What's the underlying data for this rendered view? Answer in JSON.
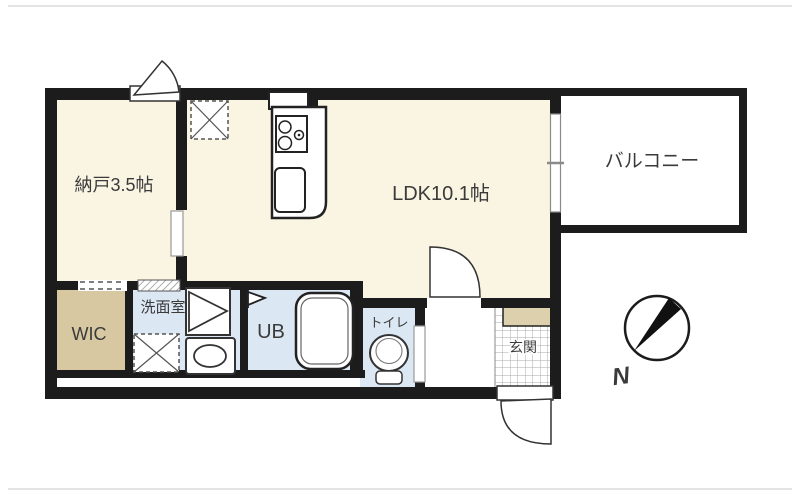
{
  "floorplan": {
    "rooms": {
      "nando": {
        "label": "納戸3.5帖"
      },
      "ldk": {
        "label": "LDK10.1帖"
      },
      "balcony": {
        "label": "バルコニー"
      },
      "wic": {
        "label": "WIC"
      },
      "senmen": {
        "label": "洗面室"
      },
      "ub": {
        "label": "UB"
      },
      "toilet": {
        "label": "トイレ"
      },
      "genkan": {
        "label": "玄関"
      }
    },
    "compass": {
      "north_label": "N"
    },
    "colors": {
      "wall": "#1c1c1c",
      "room_cream": "#f9f5e2",
      "room_blue": "#dbe7f3",
      "room_tan": "#d7c8a2",
      "genkan_step_tan": "#ddd0ac"
    }
  }
}
